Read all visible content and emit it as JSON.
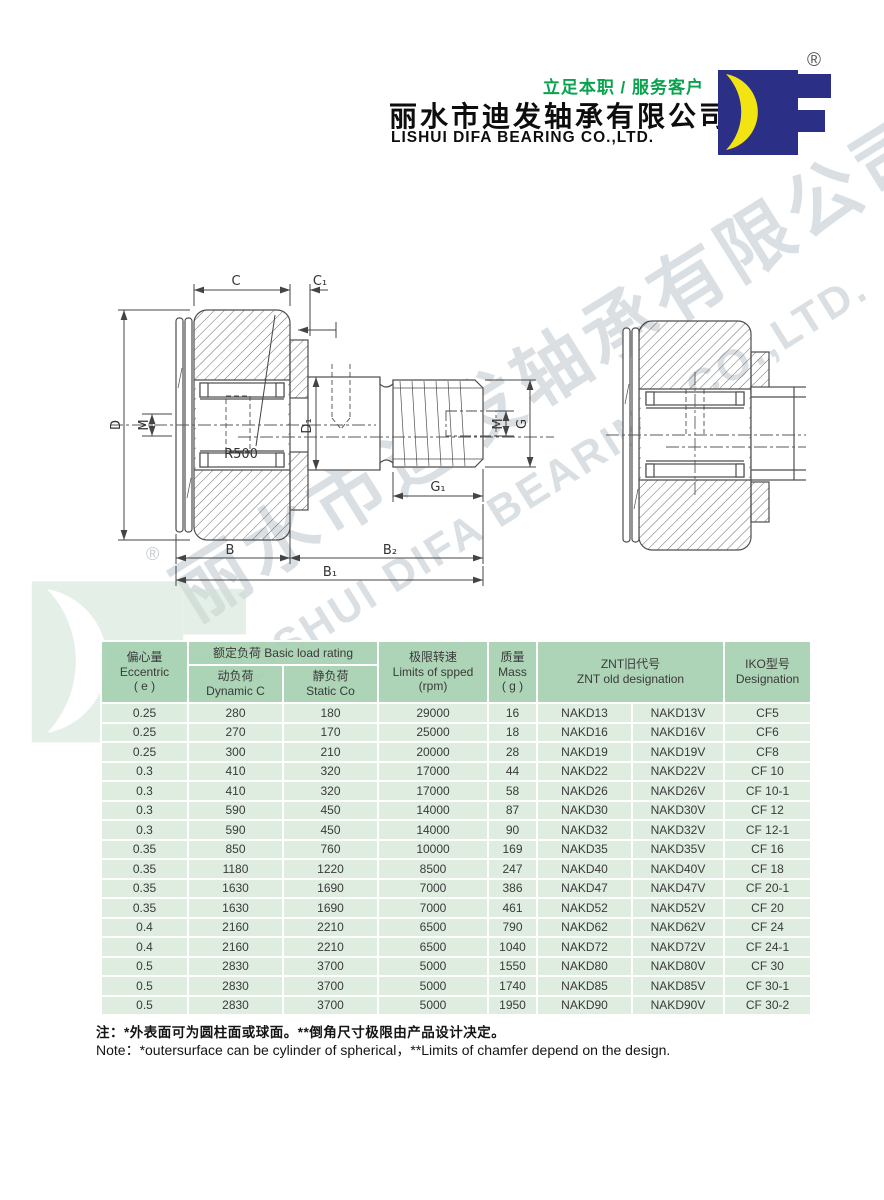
{
  "brand": {
    "slogan": "立足本职 / 服务客户",
    "company_cn": "丽水市迪发轴承有限公司",
    "company_en": "LISHUI DIFA BEARING CO.,LTD.",
    "registered": "®",
    "logo_letters": "DF",
    "colors": {
      "slogan_green": "#0aa24e",
      "logo_blue": "#2b2f85",
      "logo_yellow": "#f2e312"
    }
  },
  "watermark": {
    "cn": "丽水市迪发轴承有限公司",
    "en": "LISHUI DIFA BEARING CO.,LTD.",
    "registered": "®",
    "color": "#dadfe3"
  },
  "diagram": {
    "labels": {
      "c": "C",
      "c1": "C₁",
      "d": "D",
      "m_left": "M",
      "r500": "R500",
      "d1": "D₁",
      "m_right": "M",
      "g": "G",
      "g1": "G₁",
      "b": "B",
      "b2": "B₂",
      "b1": "B₁"
    }
  },
  "table": {
    "colors": {
      "header_green": "#a7d1b0",
      "row_green": "#dbecde"
    },
    "headers": {
      "eccentric": {
        "cn": "偏心量",
        "en": "Eccentric",
        "unit": "( e )"
      },
      "basic_load": {
        "label": "额定负荷 Basic load rating"
      },
      "dynamic": {
        "cn": "动负荷",
        "en": "Dynamic C"
      },
      "static": {
        "cn": "静负荷",
        "en": "Static Co"
      },
      "speed": {
        "cn": "极限转速",
        "en": "Limits of spped",
        "unit": "(rpm)"
      },
      "mass": {
        "cn": "质量",
        "en": "Mass",
        "unit": "( g )"
      },
      "znt": {
        "cn": "ZNT旧代号",
        "en": "ZNT old designation"
      },
      "iko": {
        "cn": "IKO型号",
        "en": "Designation"
      }
    },
    "rows": [
      [
        "0.25",
        "280",
        "180",
        "29000",
        "16",
        "NAKD13",
        "NAKD13V",
        "CF5"
      ],
      [
        "0.25",
        "270",
        "170",
        "25000",
        "18",
        "NAKD16",
        "NAKD16V",
        "CF6"
      ],
      [
        "0.25",
        "300",
        "210",
        "20000",
        "28",
        "NAKD19",
        "NAKD19V",
        "CF8"
      ],
      [
        "0.3",
        "410",
        "320",
        "17000",
        "44",
        "NAKD22",
        "NAKD22V",
        "CF 10"
      ],
      [
        "0.3",
        "410",
        "320",
        "17000",
        "58",
        "NAKD26",
        "NAKD26V",
        "CF 10-1"
      ],
      [
        "0.3",
        "590",
        "450",
        "14000",
        "87",
        "NAKD30",
        "NAKD30V",
        "CF 12"
      ],
      [
        "0.3",
        "590",
        "450",
        "14000",
        "90",
        "NAKD32",
        "NAKD32V",
        "CF 12-1"
      ],
      [
        "0.35",
        "850",
        "760",
        "10000",
        "169",
        "NAKD35",
        "NAKD35V",
        "CF 16"
      ],
      [
        "0.35",
        "1180",
        "1220",
        "8500",
        "247",
        "NAKD40",
        "NAKD40V",
        "CF 18"
      ],
      [
        "0.35",
        "1630",
        "1690",
        "7000",
        "386",
        "NAKD47",
        "NAKD47V",
        "CF 20-1"
      ],
      [
        "0.35",
        "1630",
        "1690",
        "7000",
        "461",
        "NAKD52",
        "NAKD52V",
        "CF 20"
      ],
      [
        "0.4",
        "2160",
        "2210",
        "6500",
        "790",
        "NAKD62",
        "NAKD62V",
        "CF 24"
      ],
      [
        "0.4",
        "2160",
        "2210",
        "6500",
        "1040",
        "NAKD72",
        "NAKD72V",
        "CF 24-1"
      ],
      [
        "0.5",
        "2830",
        "3700",
        "5000",
        "1550",
        "NAKD80",
        "NAKD80V",
        "CF 30"
      ],
      [
        "0.5",
        "2830",
        "3700",
        "5000",
        "1740",
        "NAKD85",
        "NAKD85V",
        "CF 30-1"
      ],
      [
        "0.5",
        "2830",
        "3700",
        "5000",
        "1950",
        "NAKD90",
        "NAKD90V",
        "CF 30-2"
      ]
    ]
  },
  "notes": {
    "cn": "注：*外表面可为圆柱面或球面。**倒角尺寸极限由产品设计决定。",
    "en": "Note：*outersurface can be cylinder of spherical，**Limits of chamfer depend on the design."
  }
}
